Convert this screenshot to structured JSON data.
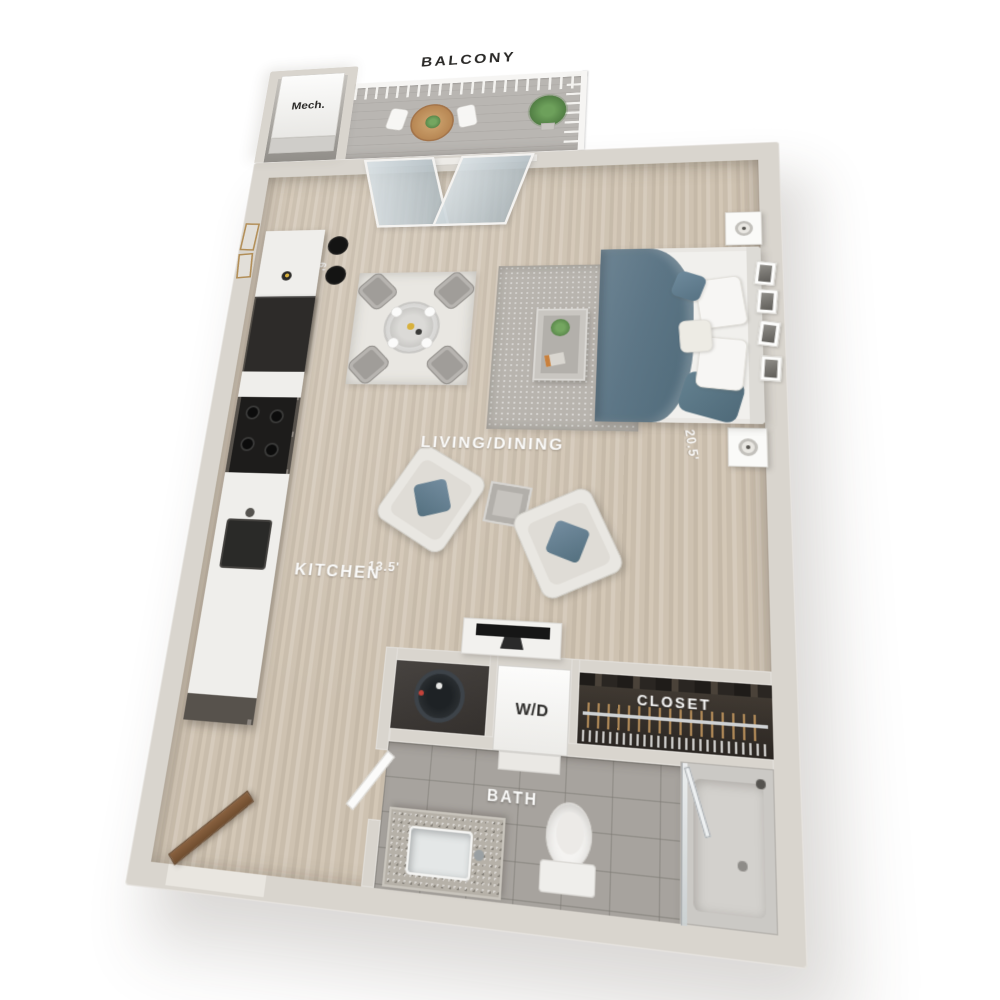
{
  "labels": {
    "mech": "Mech.",
    "balcony": "BALCONY",
    "living_dining": "LIVING/DINING",
    "kitchen": "KITCHEN",
    "washer_dryer": "W/D",
    "closet": "CLOSET",
    "bath": "BATH"
  },
  "dimensions": {
    "top_width": "21'",
    "kitchen_depth": "6'",
    "lower_width": "13.5'",
    "right_height": "20.5'"
  },
  "colors": {
    "wall": "#d9d5ce",
    "wall_shade": "#c7c3bb",
    "floor_wood": "#cabdac",
    "balcony_floor": "#b6b3af",
    "tile": "#a7a39e",
    "cabinet": "#57524c",
    "appliance": "#232220",
    "counter": "#efeeeb",
    "rug_light": "#e9e7e2",
    "rug_gray": "#b8b4ae",
    "bed_white": "#f1f0ed",
    "accent_blue": "#627d8f",
    "railing": "#f6f5f3",
    "plant": "#5f9150",
    "door_wood": "#7d5b3b",
    "closet_dark": "#352f2a",
    "label_dark": "#2b2a28",
    "label_light": "#fbfbfa",
    "dim_line": "#ffffff"
  }
}
